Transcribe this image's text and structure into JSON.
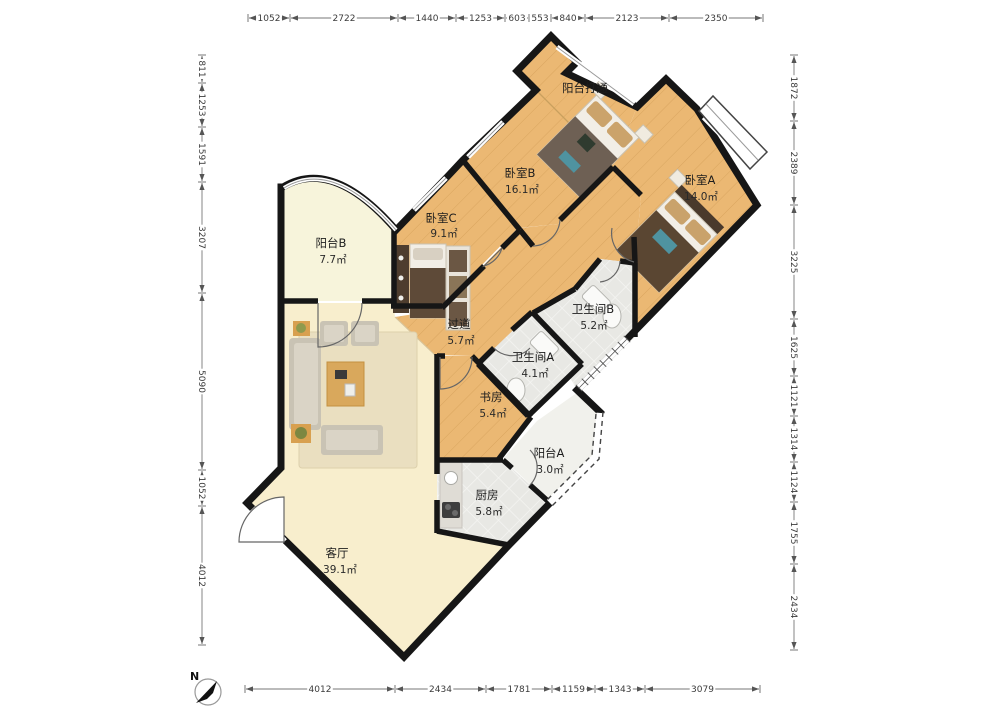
{
  "plan_type": "apartment-floor-plan",
  "rooms": [
    {
      "id": "yangtai-datong",
      "name": "阳台打通",
      "area": ""
    },
    {
      "id": "woshi-b",
      "name": "卧室B",
      "area": "16.1㎡"
    },
    {
      "id": "woshi-a",
      "name": "卧室A",
      "area": "14.0㎡"
    },
    {
      "id": "woshi-c",
      "name": "卧室C",
      "area": "9.1㎡"
    },
    {
      "id": "yangtai-b",
      "name": "阳台B",
      "area": "7.7㎡"
    },
    {
      "id": "guodao",
      "name": "过道",
      "area": "5.7㎡"
    },
    {
      "id": "weishengjian-b",
      "name": "卫生间B",
      "area": "5.2㎡"
    },
    {
      "id": "weishengjian-a",
      "name": "卫生间A",
      "area": "4.1㎡"
    },
    {
      "id": "shufang",
      "name": "书房",
      "area": "5.4㎡"
    },
    {
      "id": "yangtai-a",
      "name": "阳台A",
      "area": "3.0㎡"
    },
    {
      "id": "chufang",
      "name": "厨房",
      "area": "5.8㎡"
    },
    {
      "id": "keting",
      "name": "客厅",
      "area": "39.1㎡"
    }
  ],
  "dimensions": {
    "top": [
      "1052",
      "2722",
      "1440",
      "1253",
      "603",
      "553",
      "840",
      "2123",
      "2350"
    ],
    "left": [
      "811",
      "1253",
      "1591",
      "3207",
      "5090",
      "1052",
      "4012"
    ],
    "right": [
      "1872",
      "2389",
      "3225",
      "1625",
      "1121",
      "1314",
      "1124",
      "1755",
      "2434"
    ],
    "bottom": [
      "4012",
      "2434",
      "1781",
      "1159",
      "1343",
      "3079"
    ]
  },
  "compass": {
    "label": "N"
  },
  "colors": {
    "wall": "#161616",
    "wood_floor": "#EBB873",
    "tile_floor": "#E8E8E4",
    "living_floor": "#F8EECD",
    "balcony_floor": "#F7F4DB",
    "balcony_a_floor": "#F1F1EC",
    "dim_text": "#3b3b3b"
  }
}
